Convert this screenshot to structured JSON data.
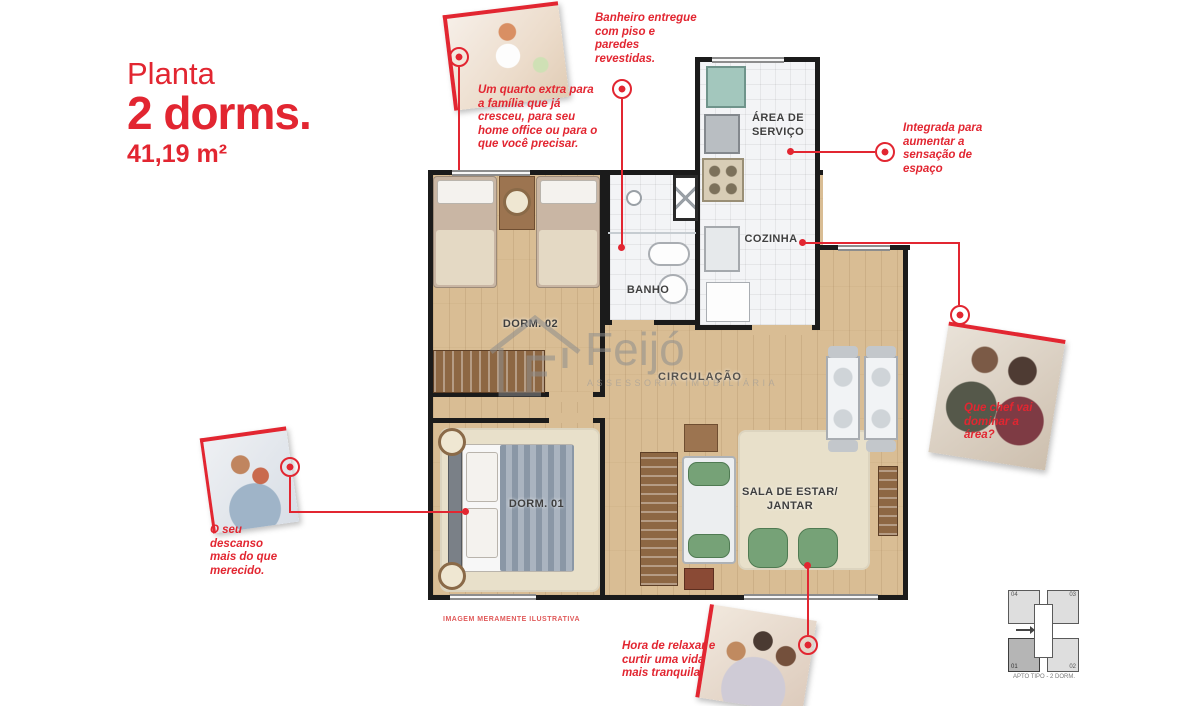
{
  "colors": {
    "accent_red": "#e22631",
    "wall": "#1b1b1b",
    "wood_floor": "#d9bd94"
  },
  "header": {
    "kicker": "Planta",
    "title": "2 dorms.",
    "area": "41,19 m²"
  },
  "annotations": {
    "bedroom2": "Um quarto extra para a família que já cresceu, para seu home office ou para o que você precisar.",
    "bathroom": "Banheiro entregue com piso e paredes revestidas.",
    "service": "Integrada para aumentar a sensação de espaço",
    "kitchen": "Que chef vai dominar a área?",
    "bedroom1": "O seu descanso mais do que merecido.",
    "living": "Hora de relaxar e curtir uma vida mais tranquila."
  },
  "rooms": {
    "dorm2": "DORM. 02",
    "banho": "BANHO",
    "servico": "ÁREA DE SERVIÇO",
    "cozinha": "COZINHA",
    "circulacao": "CIRCULAÇÃO",
    "dorm1": "DORM. 01",
    "sala": "SALA DE ESTAR/ JANTAR"
  },
  "watermark": {
    "name": "Feijó",
    "tagline": "ASSESSORIA IMOBILIÁRIA"
  },
  "disclaimer": "IMAGEM MERAMENTE ILUSTRATIVA",
  "keyplan": {
    "units": [
      "04",
      "03",
      "01",
      "02"
    ],
    "highlighted": "01",
    "caption": "APTO TIPO - 2 DORM."
  },
  "photos": [
    "child-jumping-on-bed",
    "couple-cooking",
    "couple-resting-in-bed",
    "family-on-sofa"
  ]
}
